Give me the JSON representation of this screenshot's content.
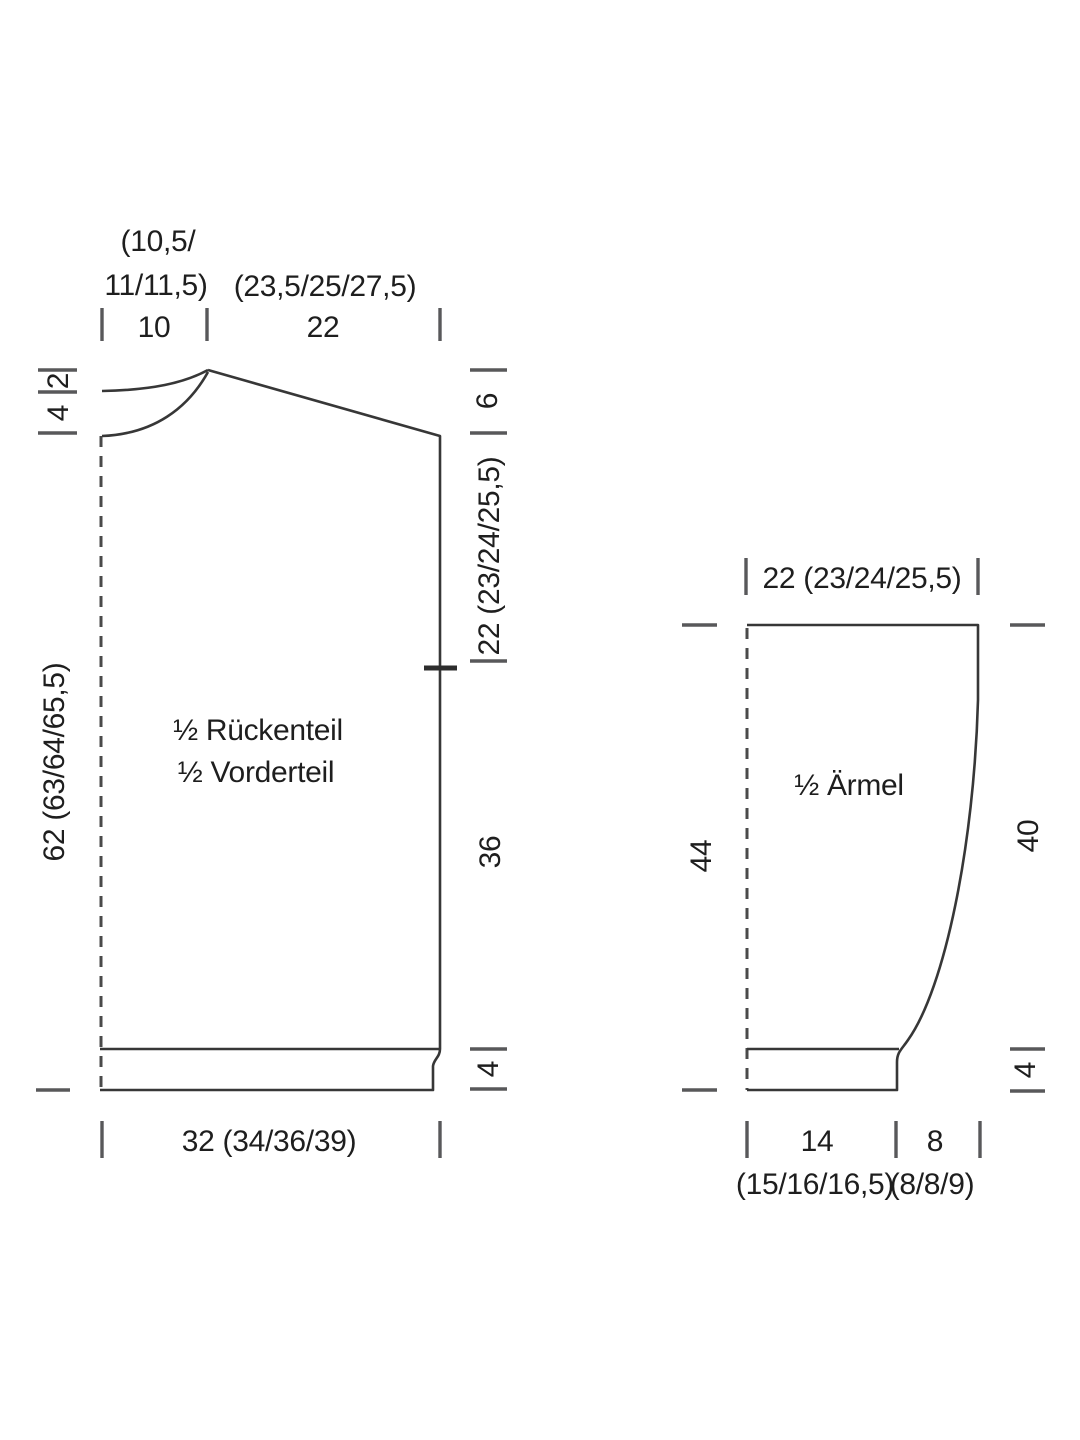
{
  "diagram_title": "Schnittschema",
  "units_note": "",
  "colors": {
    "background": "#ffffff",
    "outline": "#373737",
    "tick": "#58585a",
    "text": "#1e1e1e"
  },
  "body_piece": {
    "label_line1": "½ Rückenteil",
    "label_line2": "½ Vorderteil",
    "top": {
      "neck_sizes_1": "(10,5/",
      "neck_sizes_2": "11/11,5)",
      "neck_width": "10",
      "shoulder_sizes": "(23,5/25/27,5)",
      "shoulder_width": "22"
    },
    "left": {
      "back_neck_depth": "2",
      "front_neck_depth": "4",
      "total_length": "62 (63/64/65,5)"
    },
    "right": {
      "shoulder_drop": "6",
      "armhole_depth": "22 (23/24/25,5)",
      "lower_length": "36",
      "rib_height": "4"
    },
    "bottom": {
      "half_width": "32 (34/36/39)"
    }
  },
  "sleeve_piece": {
    "label": "½ Ärmel",
    "top": {
      "width": "22 (23/24/25,5)"
    },
    "left": {
      "total_length": "44"
    },
    "right": {
      "upper_length": "40",
      "rib_height": "4"
    },
    "bottom": {
      "cuff_width": "14",
      "cuff_sizes": "(15/16/16,5)",
      "taper_width": "8",
      "taper_sizes": "(8/8/9)"
    }
  }
}
